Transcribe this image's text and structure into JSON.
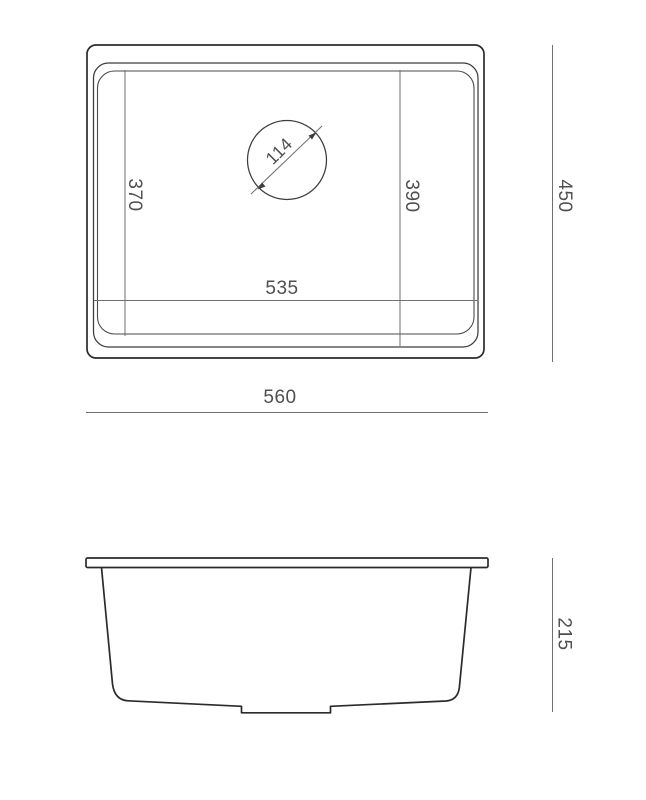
{
  "drawing": {
    "background_color": "#ffffff",
    "line_color": "#2b2b2b",
    "dimension_line_color": "#6f6f6f",
    "text_color": "#4f4f4f",
    "top_view": {
      "overall_width": "560",
      "overall_depth": "450",
      "bowl_width": "535",
      "bowl_depth_right": "390",
      "bowl_depth_left": "370",
      "drain_diameter": "114"
    },
    "side_view": {
      "overall_height": "215"
    }
  }
}
